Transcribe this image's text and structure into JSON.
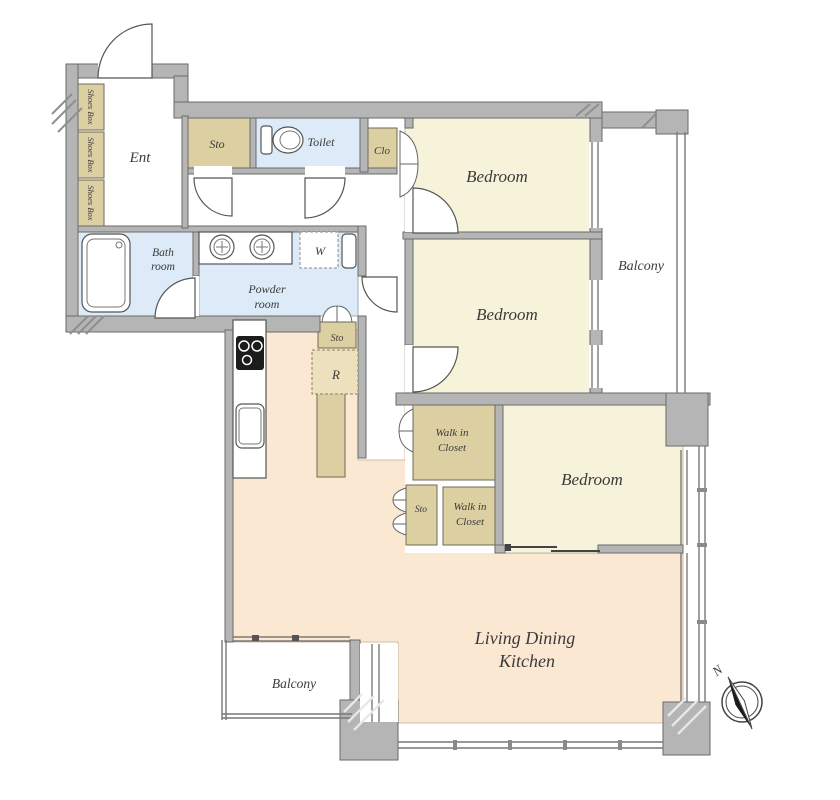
{
  "title": "Apartment floor plan",
  "rooms": {
    "ent": "Ent",
    "shoes_box": "Shoes Box",
    "sto_hall": "Sto",
    "toilet": "Toilet",
    "clo": "Clo",
    "bedroom1": "Bedroom",
    "bedroom2": "Bedroom",
    "bedroom3": "Bedroom",
    "balcony_right": "Balcony",
    "balcony_bottom": "Balcony",
    "bath_line1": "Bath",
    "bath_line2": "room",
    "powder_line1": "Powder",
    "powder_line2": "room",
    "washer": "W",
    "sto_kitchen": "Sto",
    "fridge": "R",
    "wic1_line1": "Walk in",
    "wic1_line2": "Closet",
    "sto_wic": "Sto",
    "wic2_line1": "Walk in",
    "wic2_line2": "Closet",
    "ldk_line1": "Living Dining",
    "ldk_line2": "Kitchen"
  },
  "compass": {
    "north": "N"
  },
  "colors": {
    "bedroom_fill": "#f7f3da",
    "ldk_fill": "#fbe8d3",
    "wet_area_fill": "#dcebf7",
    "storage_fill": "#dcd0a2",
    "wall_fill": "#b5b5b5",
    "label_text": "#3b3b3b"
  }
}
